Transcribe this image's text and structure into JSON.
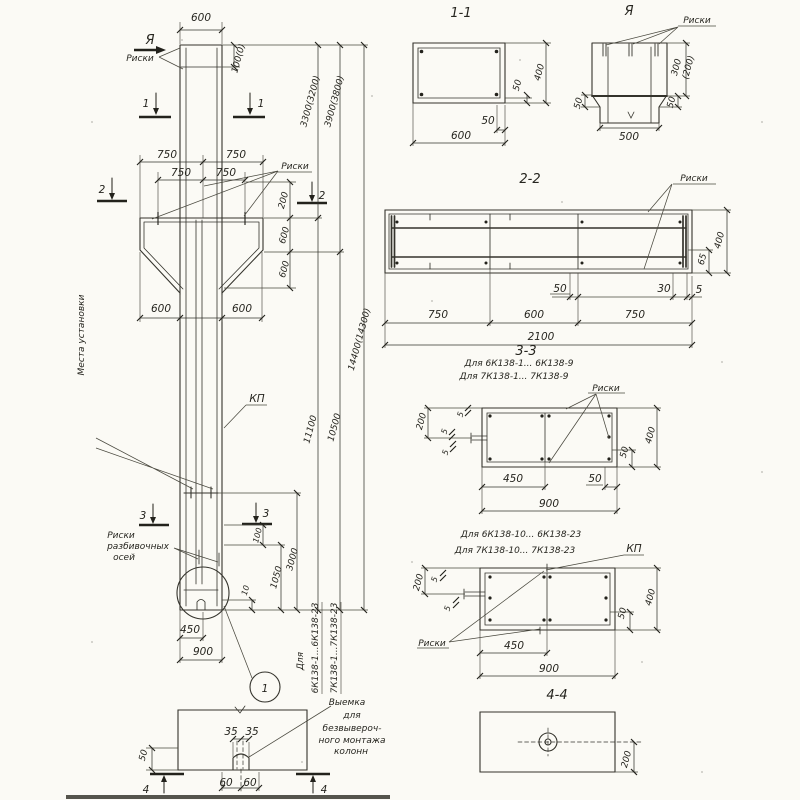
{
  "drawing": {
    "elevation": {
      "view_marker": "Я",
      "riski_top": "Риски",
      "dim_top_width": "600",
      "dim_top_riska": "100(0)",
      "sec1": "1",
      "sec2": "2",
      "sec3": "3",
      "dim_750": "750",
      "riski_mid": "Риски",
      "dim_200": "200",
      "dim_600": "600",
      "kp": "КП",
      "dim_3300": "3300(3200)",
      "dim_3900": "3900(3800)",
      "dim_11100": "11100",
      "dim_10500": "10500",
      "dim_14400": "14400(14300)",
      "note_strop_line1": "Места установки",
      "note_strop_line2": "строповочных устройств",
      "riski_axes_line1": "Риски",
      "riski_axes_line2": "разбивочных",
      "riski_axes_line3": "осей",
      "dim_100": "100",
      "dim_1050": "1050",
      "dim_10": "10",
      "dim_3000": "3000",
      "dim_450": "450",
      "dim_900": "900",
      "detail_ref": "1",
      "series_note_line1": "Для",
      "series_note_line2": "6К138-1...6К138-23",
      "series_note_line3": "7К138-1...7К138-23"
    },
    "bottom_plan": {
      "dim_35": "35",
      "dim_50": "50",
      "dim_60": "60",
      "sec4": "4",
      "note_line1": "Выемка",
      "note_line2": "для",
      "note_line3": "безвывероч-",
      "note_line4": "ного монтажа",
      "note_line5": "колонн"
    },
    "section_1_1": {
      "title": "1-1",
      "dim_50": "50",
      "dim_400": "400",
      "dim_600": "600"
    },
    "view_a": {
      "title": "Я",
      "riski": "Риски",
      "dim_300": "300",
      "dim_200p": "(200)",
      "dim_50": "50",
      "dim_500": "500"
    },
    "section_2_2": {
      "title": "2-2",
      "riski": "Риски",
      "dim_50": "50",
      "dim_30": "30",
      "dim_5": "5",
      "dim_750": "750",
      "dim_600": "600",
      "dim_2100": "2100",
      "dim_400": "400",
      "dim_65": "65"
    },
    "section_3_3_top": {
      "title": "3-3",
      "for_line1": "Для 6К138-1... 6К138-9",
      "for_line2": "Для 7К138-1... 7К138-9",
      "riski": "Риски",
      "dim_200": "200",
      "dim_5": "5",
      "dim_450": "450",
      "dim_50": "50",
      "dim_400": "400",
      "dim_900": "900"
    },
    "section_3_3_bottom": {
      "for_line1": "Для 6К138-10... 6К138-23",
      "for_line2": "Для 7К138-10... 7К138-23",
      "kp": "КП",
      "riski": "Риски",
      "dim_200": "200",
      "dim_5": "5",
      "dim_450": "450",
      "dim_900": "900",
      "dim_400": "400",
      "dim_50": "50"
    },
    "section_4_4": {
      "title": "4-4",
      "dim_200": "200"
    }
  }
}
